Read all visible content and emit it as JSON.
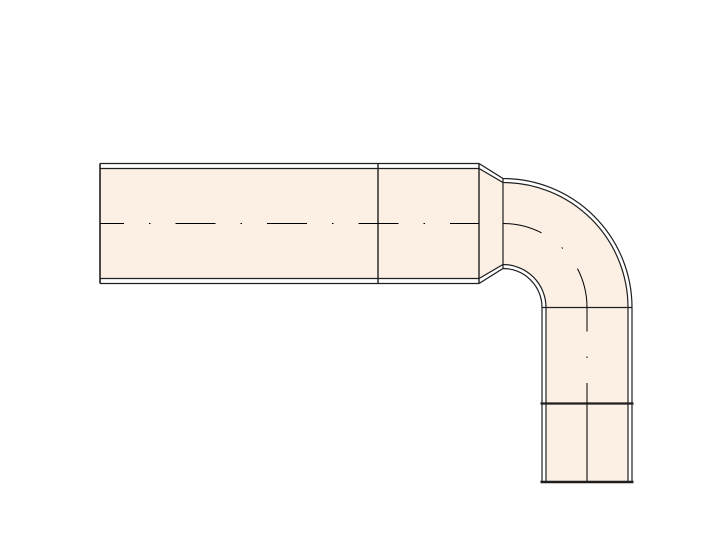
{
  "canvas": {
    "width": 713,
    "height": 540,
    "background": "#ffffff"
  },
  "drawing": {
    "type": "technical-drawing",
    "subject": "90-degree pipe elbow assembly, elevation view",
    "colors": {
      "fill": "#fcefe4",
      "line": "#1f1f1f",
      "centerline": "#000000",
      "wall_gap": "#ffffff"
    },
    "bend_center": {
      "x": 503,
      "y": 307.5
    },
    "radii": {
      "inner": 39,
      "bore_inner": 43,
      "bore_outer": 125,
      "outer": 129,
      "centerline": 84
    },
    "horizontal_pipe": {
      "x_start": 100,
      "x_end": 479,
      "y_top": 163.5,
      "y_bottom": 283.5,
      "wall": 5,
      "joint_x": 378,
      "centerline_y": 223.5
    },
    "taper": {
      "x_start": 479,
      "x_end": 503
    },
    "vertical_pipe": {
      "x_left": 542,
      "x_right": 632,
      "y_top": 307.5,
      "y_bottom": 482,
      "wall": 4,
      "joint_y": 403.5,
      "centerline_x": 587,
      "joint_overhang": 1.5
    },
    "centerline_dash": "40 25 1.5 25",
    "centerline_dash_offset": 16,
    "stroke_widths": {
      "wall": 1.2,
      "cap": 1.6,
      "joint": 1.4,
      "face": 1.2,
      "heavy_joint": 2.2,
      "end_cap": 2.6,
      "centerline": 1,
      "seam": 1.2
    }
  }
}
